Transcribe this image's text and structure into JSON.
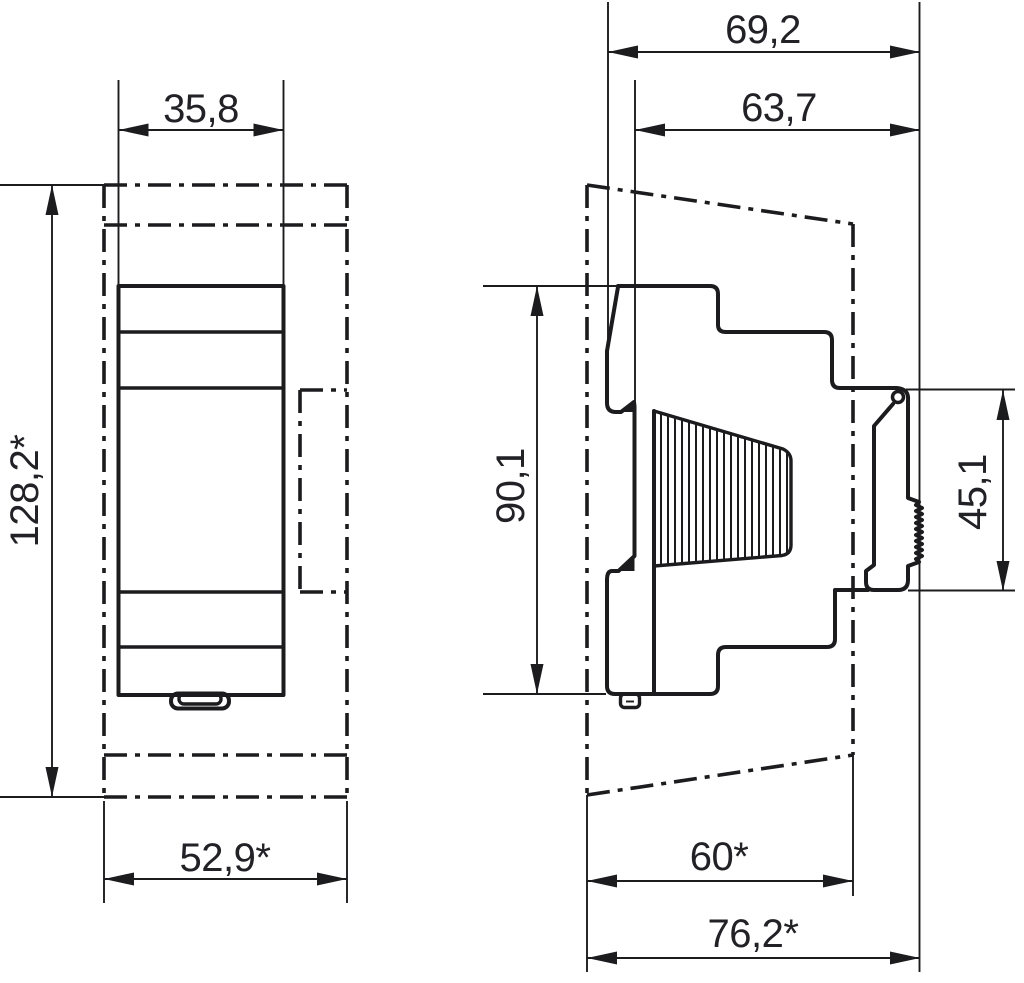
{
  "drawing": {
    "type": "technical-dimension-drawing",
    "colors": {
      "line": "#1c1c1f",
      "background": "#ffffff"
    },
    "front_view": {
      "dim_width_top": "35,8",
      "dim_height": "128,2*",
      "dim_width_bottom": "52,9*"
    },
    "side_view": {
      "dim_depth_total": "69,2",
      "dim_depth_upper": "63,7",
      "dim_height_body": "90,1",
      "dim_rail_height": "45,1",
      "dim_depth_lower": "60*",
      "dim_depth_overall": "76,2*"
    }
  }
}
